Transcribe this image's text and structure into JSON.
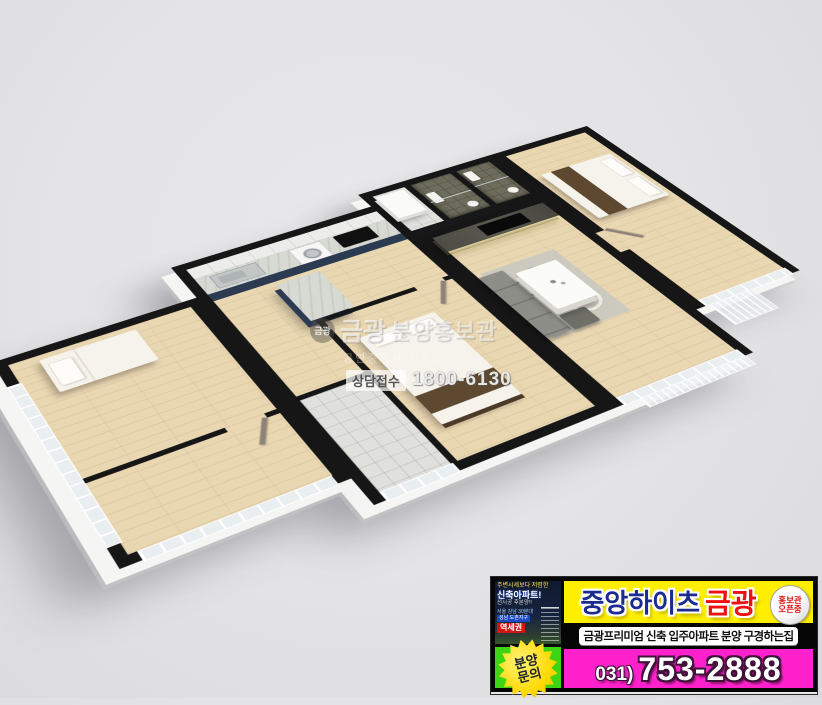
{
  "scene": {
    "description": "3D isometric cutaway floor plan of a 3-bedroom apartment, viewed from above"
  },
  "palette": {
    "background": "#e4e4e6",
    "wall_top": "#161616",
    "wood_floor": "#e9d7b2",
    "navy_cabinet": "#2c3a52",
    "banner_yellow": "#ffee00",
    "banner_magenta": "#ff22cc",
    "banner_green": "#3ed514",
    "title_navy": "#1c2b8f",
    "title_red": "#ee1111"
  },
  "watermark": {
    "logo": "금광",
    "brand": "금광",
    "line1": "분양홍보관",
    "line2": "공인중개사 사무소",
    "contact_label": "상담접수",
    "contact_number": "1800-6130"
  },
  "banner": {
    "title_main": "중앙하이츠",
    "title_accent": "금광",
    "badge_line1": "홍보관",
    "badge_line2": "오픈중",
    "subtitle": "금광프리미엄 신축 입주아파트 분양 구경하는집",
    "phone_prefix": "031)",
    "phone_number": "753-2888",
    "starburst_line1": "분양",
    "starburst_line2": "문의",
    "thumb": {
      "caption_top": "주변시세보다 저렴한",
      "caption_main": "신축아파트!",
      "caption_sub": "선시공 후분양!!",
      "caption_loc1": "서울 강남 30분대",
      "caption_loc2": "성남 도촌지구",
      "caption_station": "역세권"
    }
  }
}
